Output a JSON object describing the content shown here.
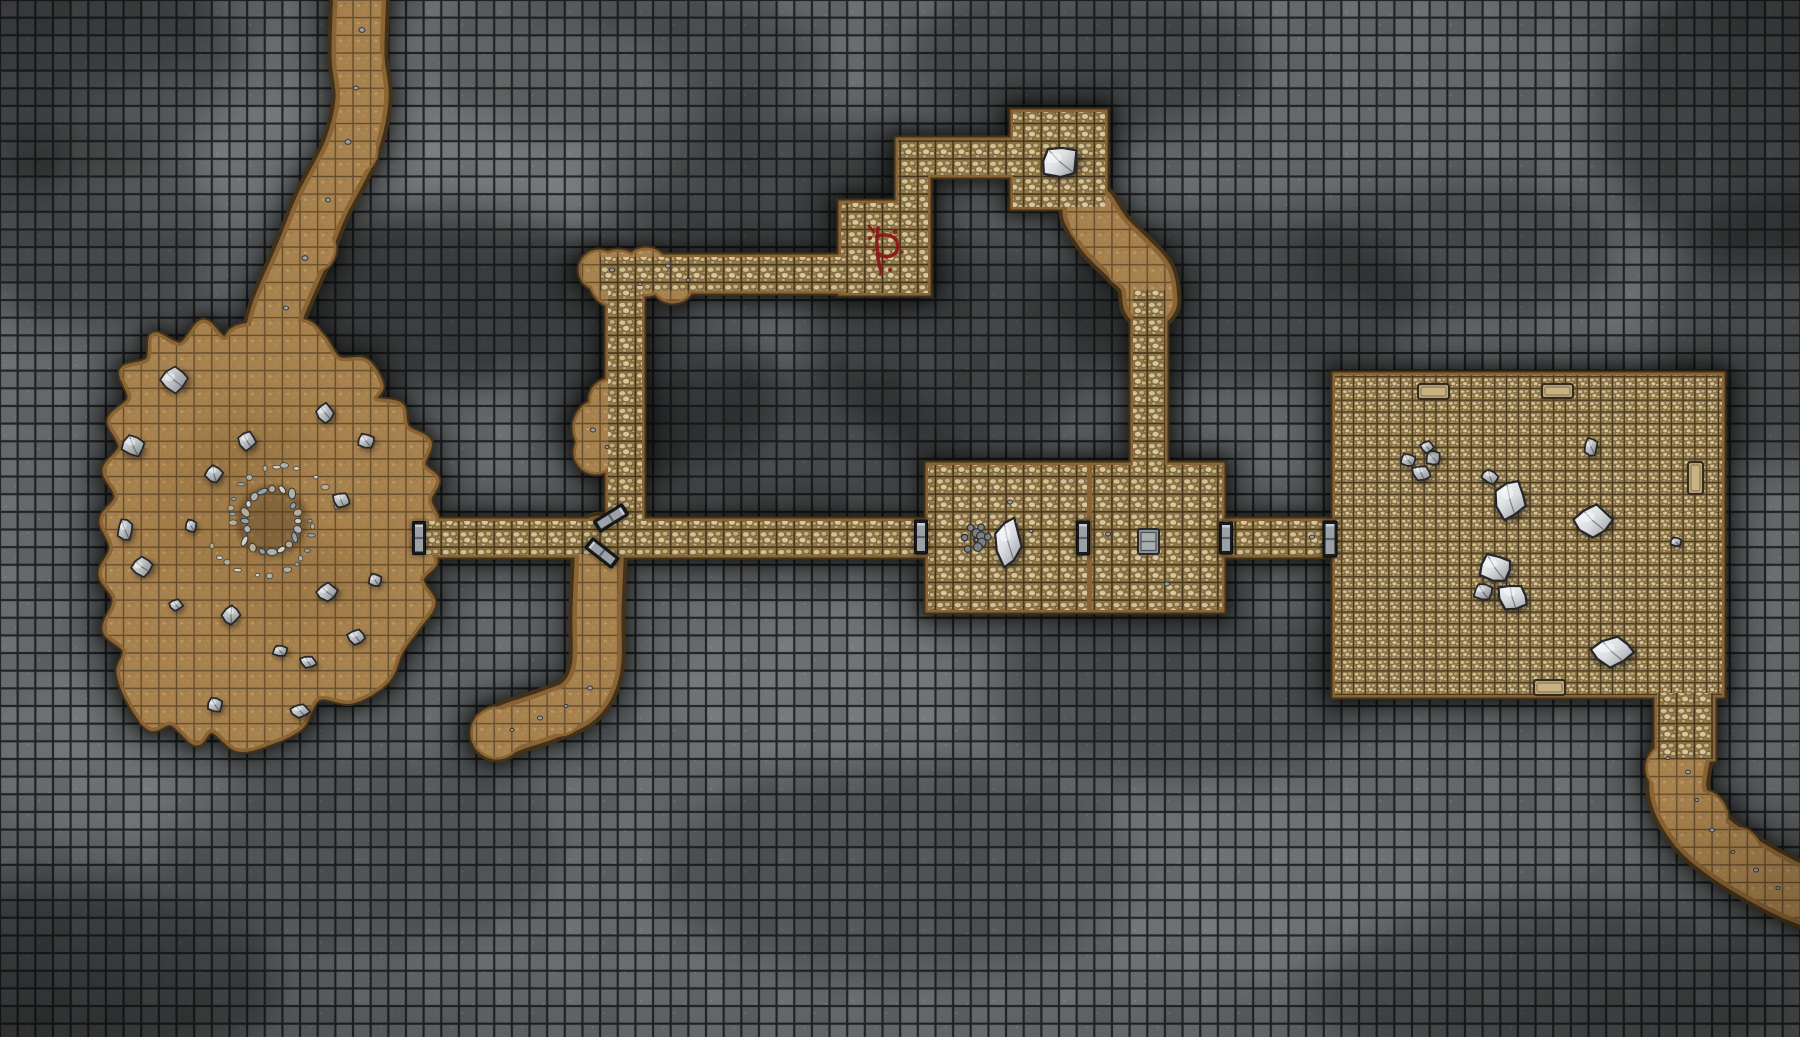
{
  "meta": {
    "title": "stone-dungeon-battle-map",
    "canvas_width": 1800,
    "canvas_height": 1037,
    "grid_size": 17.65,
    "fine_grid_size": 11.77
  },
  "palette": {
    "bg_base": "#646869",
    "bg_grid_line": "#101215",
    "shadow": "#000000",
    "wall_dark": "#43321a",
    "wall_brown": "#8a6434",
    "floor_gap": "#957b49",
    "floor_stone_light": "#d9c79d",
    "floor_stone_mid": "#c6b07f",
    "cave_base": "#a8824e",
    "cave_pebble": "#c09a64",
    "door_frame": "#181b1e",
    "door_face": "#9ba1a6",
    "rock_light": "#f0f2f3",
    "rock_mid": "#bfc3c6",
    "rock_dark": "#7c8084",
    "rock_outline": "#24262a",
    "slab_fill": "#c9b282",
    "slab_outline": "#342b1d",
    "rune_red": "#8a1511"
  },
  "map": {
    "built_rooms": [
      {
        "name": "room-middle-west",
        "x": 928,
        "y": 465,
        "w": 159,
        "h": 145,
        "grid": "normal"
      },
      {
        "name": "room-middle-east",
        "x": 1092,
        "y": 465,
        "w": 130,
        "h": 145,
        "grid": "normal"
      },
      {
        "name": "room-top-small",
        "x": 1013,
        "y": 112,
        "w": 92,
        "h": 95,
        "grid": "normal"
      },
      {
        "name": "rune-alcove",
        "x": 841,
        "y": 203,
        "w": 87,
        "h": 90,
        "grid": "normal"
      },
      {
        "name": "great-hall",
        "x": 1335,
        "y": 375,
        "w": 387,
        "h": 320,
        "grid": "fine"
      },
      {
        "name": "hall-exit-stub",
        "x": 1657,
        "y": 693,
        "w": 56,
        "h": 66,
        "grid": "normal"
      }
    ],
    "built_corridors": [
      {
        "name": "main-corridor-west",
        "x": 425,
        "y": 521,
        "w": 503,
        "h": 34
      },
      {
        "name": "main-corridor-east",
        "x": 1222,
        "y": 521,
        "w": 118,
        "h": 34
      },
      {
        "name": "north-corridor",
        "x": 600,
        "y": 257,
        "w": 328,
        "h": 34
      },
      {
        "name": "top-room-link",
        "x": 898,
        "y": 140,
        "w": 115,
        "h": 35
      },
      {
        "name": "alcove-shaft",
        "x": 898,
        "y": 140,
        "w": 30,
        "h": 152
      },
      {
        "name": "mid-shaft",
        "x": 608,
        "y": 291,
        "w": 34,
        "h": 233
      },
      {
        "name": "room-east-shaft",
        "x": 1133,
        "y": 290,
        "w": 32,
        "h": 178
      }
    ],
    "natural_blobs": [
      {
        "name": "cave-chamber",
        "points": [
          [
            240,
            328
          ],
          [
            300,
            322
          ],
          [
            322,
            338
          ],
          [
            338,
            360
          ],
          [
            365,
            362
          ],
          [
            380,
            385
          ],
          [
            374,
            400
          ],
          [
            400,
            406
          ],
          [
            406,
            428
          ],
          [
            428,
            442
          ],
          [
            422,
            465
          ],
          [
            436,
            480
          ],
          [
            428,
            500
          ],
          [
            436,
            522
          ],
          [
            427,
            545
          ],
          [
            434,
            562
          ],
          [
            420,
            580
          ],
          [
            432,
            603
          ],
          [
            418,
            625
          ],
          [
            400,
            650
          ],
          [
            386,
            680
          ],
          [
            352,
            700
          ],
          [
            318,
            697
          ],
          [
            300,
            726
          ],
          [
            268,
            742
          ],
          [
            238,
            748
          ],
          [
            212,
            729
          ],
          [
            196,
            742
          ],
          [
            172,
            722
          ],
          [
            150,
            727
          ],
          [
            130,
            700
          ],
          [
            120,
            672
          ],
          [
            126,
            650
          ],
          [
            106,
            630
          ],
          [
            116,
            600
          ],
          [
            102,
            574
          ],
          [
            113,
            548
          ],
          [
            103,
            520
          ],
          [
            118,
            497
          ],
          [
            106,
            470
          ],
          [
            122,
            447
          ],
          [
            111,
            420
          ],
          [
            131,
            399
          ],
          [
            123,
            371
          ],
          [
            149,
            361
          ],
          [
            154,
            336
          ],
          [
            181,
            346
          ],
          [
            203,
            323
          ],
          [
            224,
            340
          ]
        ]
      }
    ],
    "natural_paths": [
      {
        "name": "north-entry-passage",
        "w": 44,
        "pts": [
          [
            360,
            -12
          ],
          [
            358,
            55
          ],
          [
            362,
            100
          ],
          [
            350,
            150
          ],
          [
            322,
            205
          ],
          [
            303,
            252
          ],
          [
            280,
            305
          ],
          [
            272,
            332
          ]
        ]
      },
      {
        "name": "toproom-bend-passage",
        "w": 46,
        "pts": [
          [
            1090,
            212
          ],
          [
            1105,
            235
          ],
          [
            1128,
            258
          ],
          [
            1146,
            278
          ],
          [
            1150,
            300
          ]
        ]
      },
      {
        "name": "south-dead-end-passage",
        "w": 40,
        "pts": [
          [
            600,
            540
          ],
          [
            597,
            610
          ],
          [
            596,
            668
          ],
          [
            580,
            700
          ],
          [
            548,
            715
          ],
          [
            515,
            726
          ],
          [
            497,
            734
          ]
        ]
      },
      {
        "name": "southeast-exit-passage",
        "w": 48,
        "pts": [
          [
            1684,
            745
          ],
          [
            1678,
            790
          ],
          [
            1695,
            825
          ],
          [
            1722,
            850
          ],
          [
            1756,
            872
          ],
          [
            1790,
            890
          ],
          [
            1815,
            900
          ]
        ]
      }
    ],
    "natural_bumps": [
      [
        618,
        279,
        27
      ],
      [
        646,
        272,
        22
      ],
      [
        673,
        281,
        20
      ],
      [
        599,
        270,
        18
      ],
      [
        602,
        428,
        27
      ],
      [
        610,
        400,
        19
      ],
      [
        596,
        452,
        20
      ],
      [
        352,
        150,
        24
      ],
      [
        310,
        248,
        24
      ],
      [
        360,
        60,
        22
      ],
      [
        1092,
        222,
        22
      ],
      [
        1130,
        262,
        24
      ],
      [
        1672,
        768,
        24
      ],
      [
        1700,
        818,
        26
      ],
      [
        1735,
        855,
        26
      ],
      [
        560,
        712,
        22
      ],
      [
        497,
        733,
        24
      ]
    ],
    "doors": [
      {
        "name": "door-cave-east",
        "cx": 419,
        "cy": 538,
        "w": 13,
        "h": 33,
        "rot": 0
      },
      {
        "name": "door-room-west",
        "cx": 921,
        "cy": 537,
        "w": 13,
        "h": 34,
        "rot": 0
      },
      {
        "name": "door-between-rooms",
        "cx": 1083,
        "cy": 538,
        "w": 13,
        "h": 34,
        "rot": 0
      },
      {
        "name": "door-room-east",
        "cx": 1226,
        "cy": 538,
        "w": 13,
        "h": 32,
        "rot": 0
      },
      {
        "name": "door-great-hall",
        "cx": 1330,
        "cy": 539,
        "w": 14,
        "h": 36,
        "rot": 0
      },
      {
        "name": "door-junction-upper",
        "cx": 611,
        "cy": 518,
        "w": 13,
        "h": 34,
        "rot": 58
      },
      {
        "name": "door-junction-lower",
        "cx": 602,
        "cy": 553,
        "w": 13,
        "h": 34,
        "rot": -52
      }
    ],
    "rocks": [
      [
        174,
        380,
        14,
        13,
        -15,
        0
      ],
      [
        133,
        446,
        12,
        11,
        10,
        0
      ],
      [
        247,
        441,
        9,
        10,
        0,
        0
      ],
      [
        214,
        474,
        9,
        9,
        20,
        0
      ],
      [
        325,
        413,
        9,
        10,
        -10,
        0
      ],
      [
        366,
        441,
        9,
        8,
        0,
        0
      ],
      [
        341,
        500,
        9,
        8,
        15,
        0
      ],
      [
        125,
        530,
        8,
        12,
        0,
        0
      ],
      [
        142,
        567,
        11,
        10,
        -20,
        0
      ],
      [
        191,
        526,
        6,
        7,
        0,
        0
      ],
      [
        176,
        605,
        7,
        6,
        0,
        0
      ],
      [
        231,
        615,
        9,
        10,
        30,
        0
      ],
      [
        327,
        592,
        11,
        9,
        -15,
        0
      ],
      [
        375,
        580,
        7,
        7,
        0,
        0
      ],
      [
        356,
        637,
        9,
        8,
        0,
        0
      ],
      [
        280,
        651,
        8,
        6,
        0,
        0
      ],
      [
        308,
        662,
        9,
        6,
        10,
        0
      ],
      [
        215,
        705,
        8,
        8,
        0,
        0
      ],
      [
        300,
        711,
        10,
        7,
        0,
        0
      ],
      [
        1060,
        162,
        20,
        17,
        -12,
        1
      ],
      [
        1008,
        542,
        14,
        25,
        4,
        1
      ],
      [
        1408,
        460,
        8,
        7,
        0,
        0
      ],
      [
        1421,
        473,
        10,
        8,
        15,
        0
      ],
      [
        1433,
        458,
        8,
        8,
        -10,
        0
      ],
      [
        1427,
        447,
        7,
        6,
        0,
        0
      ],
      [
        1490,
        477,
        9,
        7,
        20,
        0
      ],
      [
        1510,
        500,
        16,
        21,
        10,
        1
      ],
      [
        1591,
        447,
        7,
        10,
        0,
        0
      ],
      [
        1593,
        521,
        20,
        16,
        -10,
        1
      ],
      [
        1495,
        568,
        17,
        15,
        0,
        1
      ],
      [
        1512,
        597,
        16,
        14,
        20,
        1
      ],
      [
        1483,
        592,
        10,
        9,
        0,
        0
      ],
      [
        1612,
        652,
        22,
        15,
        -5,
        1
      ],
      [
        1676,
        542,
        6,
        5,
        0,
        0
      ]
    ],
    "pebbles": [
      [
        362,
        30,
        3
      ],
      [
        356,
        88,
        2.5
      ],
      [
        348,
        142,
        3
      ],
      [
        328,
        200,
        2.5
      ],
      [
        305,
        258,
        3
      ],
      [
        286,
        308,
        2.5
      ],
      [
        612,
        270,
        2.5
      ],
      [
        640,
        284,
        2
      ],
      [
        668,
        266,
        2.5
      ],
      [
        688,
        280,
        2
      ],
      [
        593,
        430,
        2.5
      ],
      [
        607,
        447,
        2
      ],
      [
        590,
        688,
        2.5
      ],
      [
        566,
        706,
        2
      ],
      [
        540,
        718,
        2.5
      ],
      [
        512,
        730,
        2
      ],
      [
        1688,
        772,
        2.5
      ],
      [
        1697,
        800,
        2
      ],
      [
        1712,
        830,
        2.5
      ],
      [
        1733,
        852,
        2
      ],
      [
        1756,
        870,
        2.5
      ],
      [
        1778,
        888,
        2
      ],
      [
        1668,
        758,
        2
      ],
      [
        1108,
        534,
        2.5
      ],
      [
        1312,
        537,
        2.5
      ],
      [
        1323,
        545,
        2
      ],
      [
        1010,
        502,
        2.5
      ],
      [
        1031,
        531,
        2
      ],
      [
        1167,
        584,
        2.5
      ]
    ],
    "slabs": [
      {
        "name": "stone-slab-north-1",
        "x": 1418,
        "y": 384,
        "w": 31,
        "h": 15
      },
      {
        "name": "stone-slab-north-2",
        "x": 1542,
        "y": 384,
        "w": 31,
        "h": 14
      },
      {
        "name": "stone-slab-east",
        "x": 1688,
        "y": 462,
        "w": 15,
        "h": 32
      },
      {
        "name": "stone-slab-south",
        "x": 1534,
        "y": 680,
        "w": 31,
        "h": 15
      }
    ],
    "features": {
      "rubble_ring": {
        "name": "cave-fire-ring",
        "cx": 272,
        "cy": 521,
        "ring_r": 30,
        "scatter_r": 60,
        "ring_count": 20,
        "scatter_count": 26
      },
      "rubble_pile": {
        "name": "room-rubble-pile",
        "cx": 976,
        "cy": 540,
        "spread_x": 17,
        "spread_y": 20,
        "count": 14
      },
      "chest": {
        "name": "stone-chest",
        "x": 1138,
        "y": 529,
        "w": 21,
        "h": 25
      },
      "rune": {
        "name": "blood-rune",
        "x": 880,
        "y": 248
      }
    },
    "smudges": [
      [
        450,
        295,
        150,
        95,
        0.42
      ],
      [
        770,
        185,
        170,
        75,
        0.32
      ],
      [
        960,
        340,
        150,
        110,
        0.35
      ],
      [
        660,
        395,
        120,
        80,
        0.3
      ],
      [
        1240,
        300,
        190,
        85,
        0.3
      ],
      [
        90,
        230,
        130,
        100,
        0.3
      ],
      [
        60,
        60,
        180,
        120,
        0.3
      ],
      [
        1760,
        120,
        160,
        150,
        0.35
      ],
      [
        1780,
        330,
        120,
        140,
        0.28
      ],
      [
        780,
        440,
        170,
        80,
        0.28
      ],
      [
        1180,
        690,
        200,
        90,
        0.22
      ],
      [
        900,
        870,
        240,
        110,
        0.2
      ],
      [
        1550,
        990,
        240,
        90,
        0.22
      ],
      [
        360,
        850,
        200,
        100,
        0.18
      ],
      [
        60,
        980,
        220,
        100,
        0.3
      ],
      [
        1460,
        250,
        160,
        70,
        0.25
      ],
      [
        620,
        60,
        200,
        80,
        0.25
      ],
      [
        1080,
        60,
        180,
        80,
        0.28
      ]
    ],
    "lights": [
      [
        500,
        120,
        200,
        110,
        0.1
      ],
      [
        190,
        150,
        130,
        80,
        0.08
      ],
      [
        120,
        760,
        140,
        90,
        0.07
      ],
      [
        840,
        690,
        180,
        80,
        0.07
      ],
      [
        1240,
        880,
        200,
        90,
        0.06
      ]
    ],
    "cave_mottle": [
      [
        250,
        450,
        60,
        40,
        0.15
      ],
      [
        300,
        580,
        70,
        45,
        0.12
      ],
      [
        200,
        520,
        50,
        60,
        0.1
      ]
    ]
  }
}
